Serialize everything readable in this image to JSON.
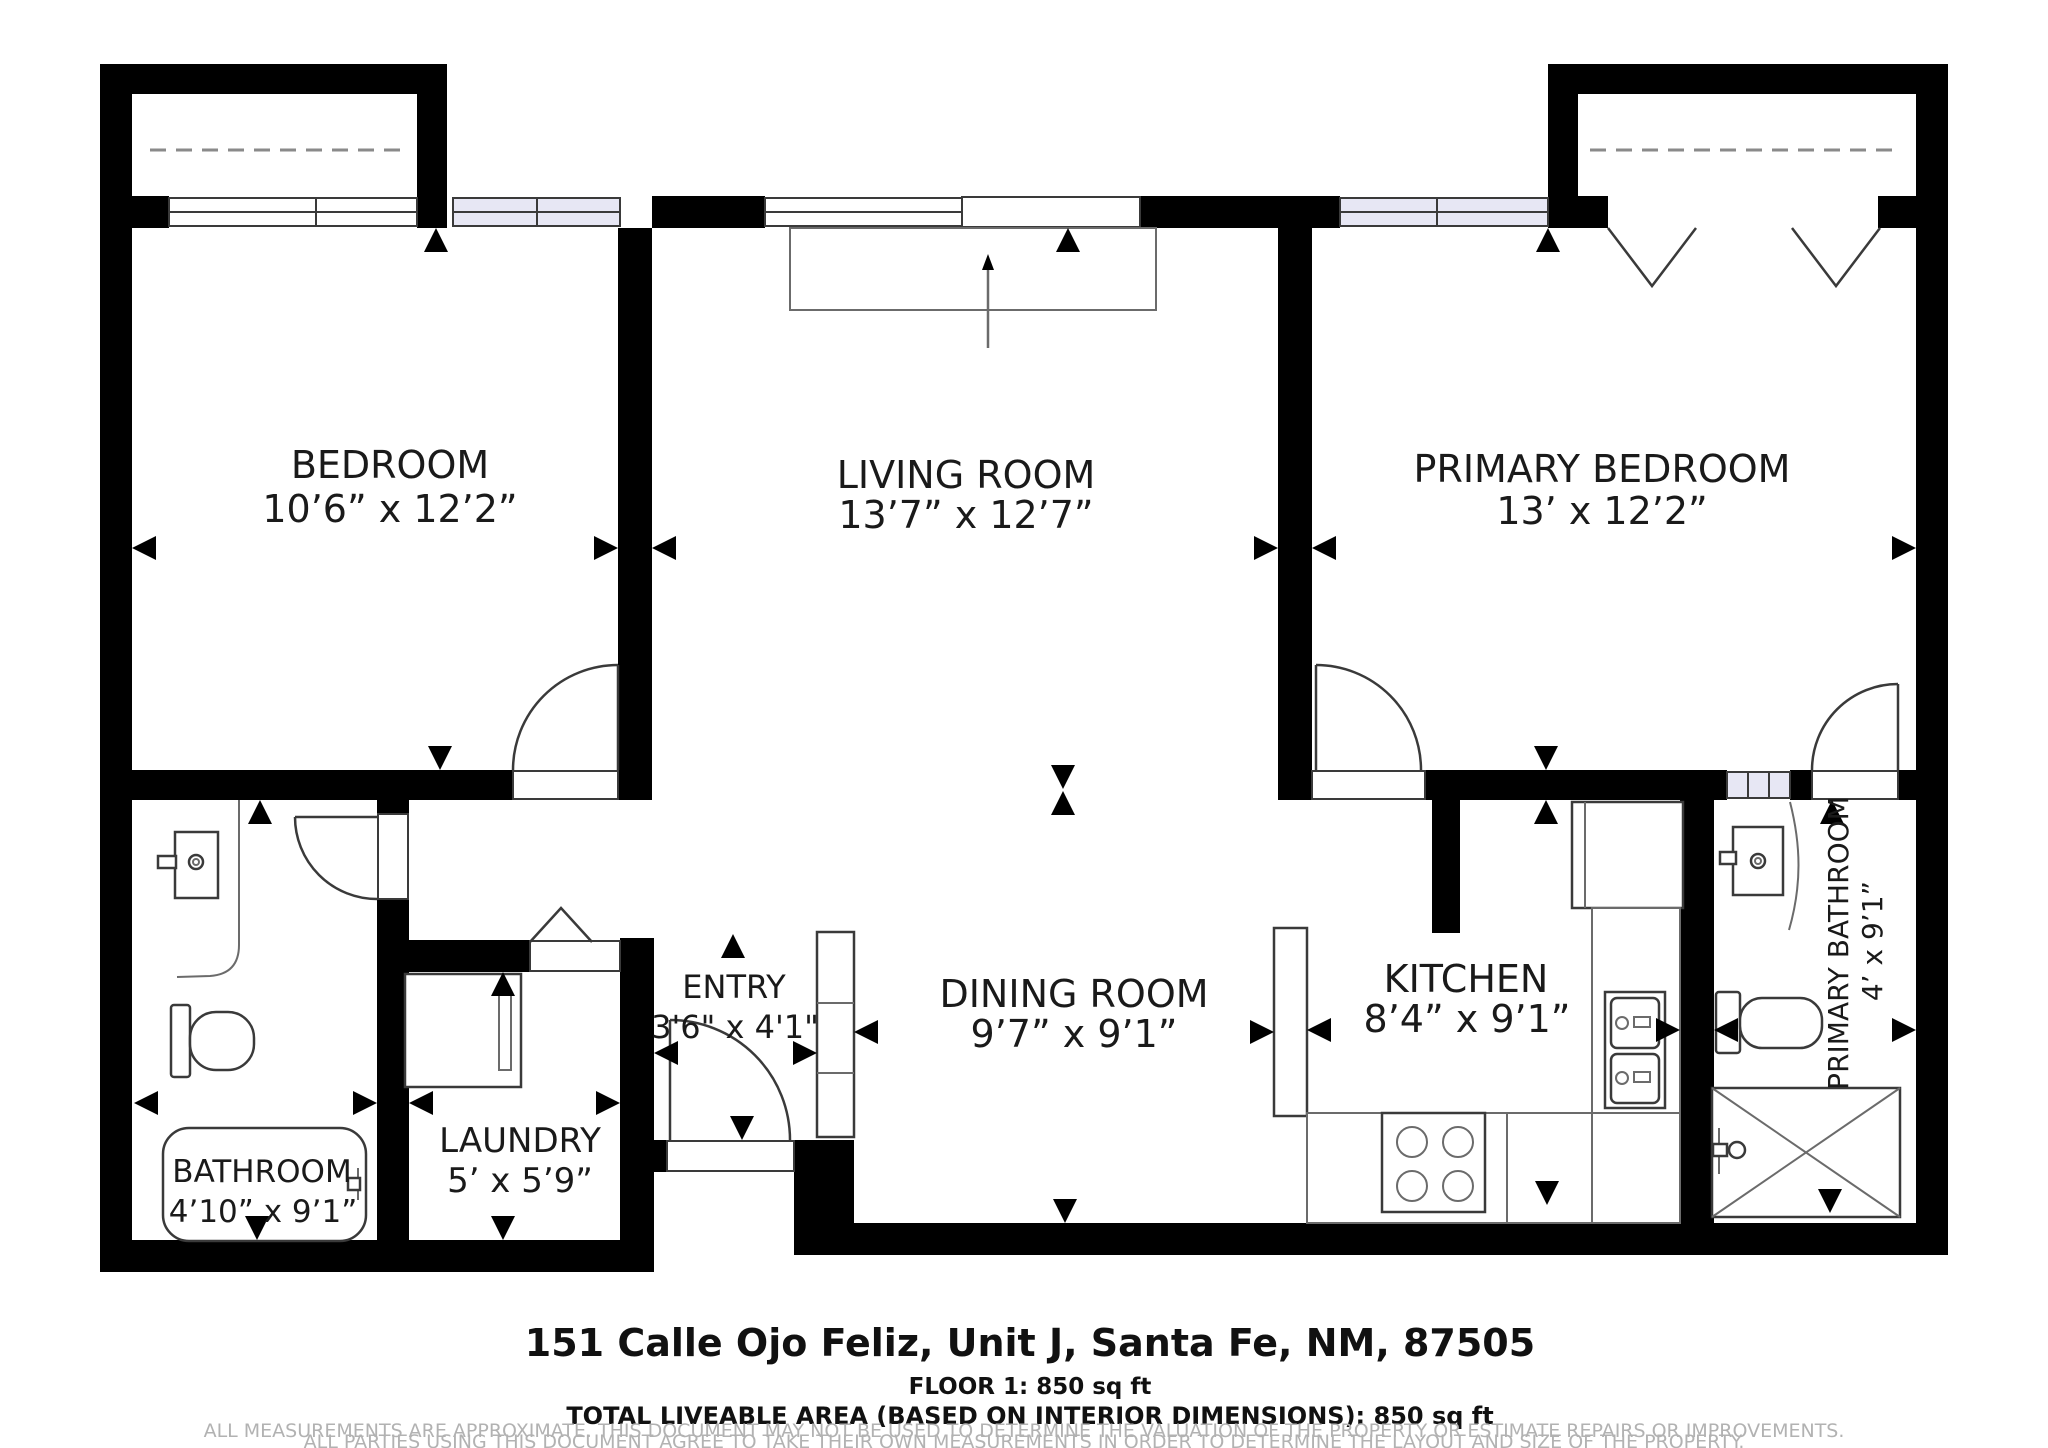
{
  "document_type": "floor-plan",
  "rooms": {
    "bedroom": {
      "name": "BEDROOM",
      "dims": "10’6” x 12’2”"
    },
    "living_room": {
      "name": "LIVING ROOM",
      "dims": "13’7” x 12’7”"
    },
    "primary_bedroom": {
      "name": "PRIMARY BEDROOM",
      "dims": "13’ x 12’2”"
    },
    "bathroom": {
      "name": "BATHROOM",
      "dims": "4’10” x 9’1”"
    },
    "laundry": {
      "name": "LAUNDRY",
      "dims": "5’ x 5’9”"
    },
    "entry": {
      "name": "ENTRY",
      "dims": "3'6\" x 4'1\""
    },
    "dining_room": {
      "name": "DINING ROOM",
      "dims": "9’7” x 9’1”"
    },
    "kitchen": {
      "name": "KITCHEN",
      "dims": "8’4” x 9’1”"
    },
    "primary_bathroom": {
      "name": "PRIMARY BATHROOM",
      "dims": "4’ x 9’1”"
    }
  },
  "footer": {
    "address": "151 Calle Ojo Feliz, Unit J, Santa Fe, NM, 87505",
    "floor_line": "FLOOR 1: 850 sq ft",
    "total_line": "TOTAL LIVEABLE AREA (BASED ON INTERIOR DIMENSIONS): 850 sq ft",
    "disclaimer_line1": "ALL MEASUREMENTS ARE APPROXIMATE. THIS DOCUMENT MAY NOT BE USED TO DETERMINE THE VALUATION OF THE PROPERTY OR ESTIMATE REPAIRS OR IMPROVEMENTS.",
    "disclaimer_line2": "ALL PARTIES USING THIS DOCUMENT AGREE TO TAKE THEIR OWN MEASUREMENTS IN ORDER TO DETERMINE THE LAYOUT AND SIZE OF THE PROPERTY."
  },
  "colors": {
    "wall": "#000000",
    "line": "#3a3a3a",
    "window_tint": "#e7e7f4",
    "label": "#1a1a1a",
    "disclaimer": "#b2b2b2",
    "bg": "#ffffff"
  }
}
